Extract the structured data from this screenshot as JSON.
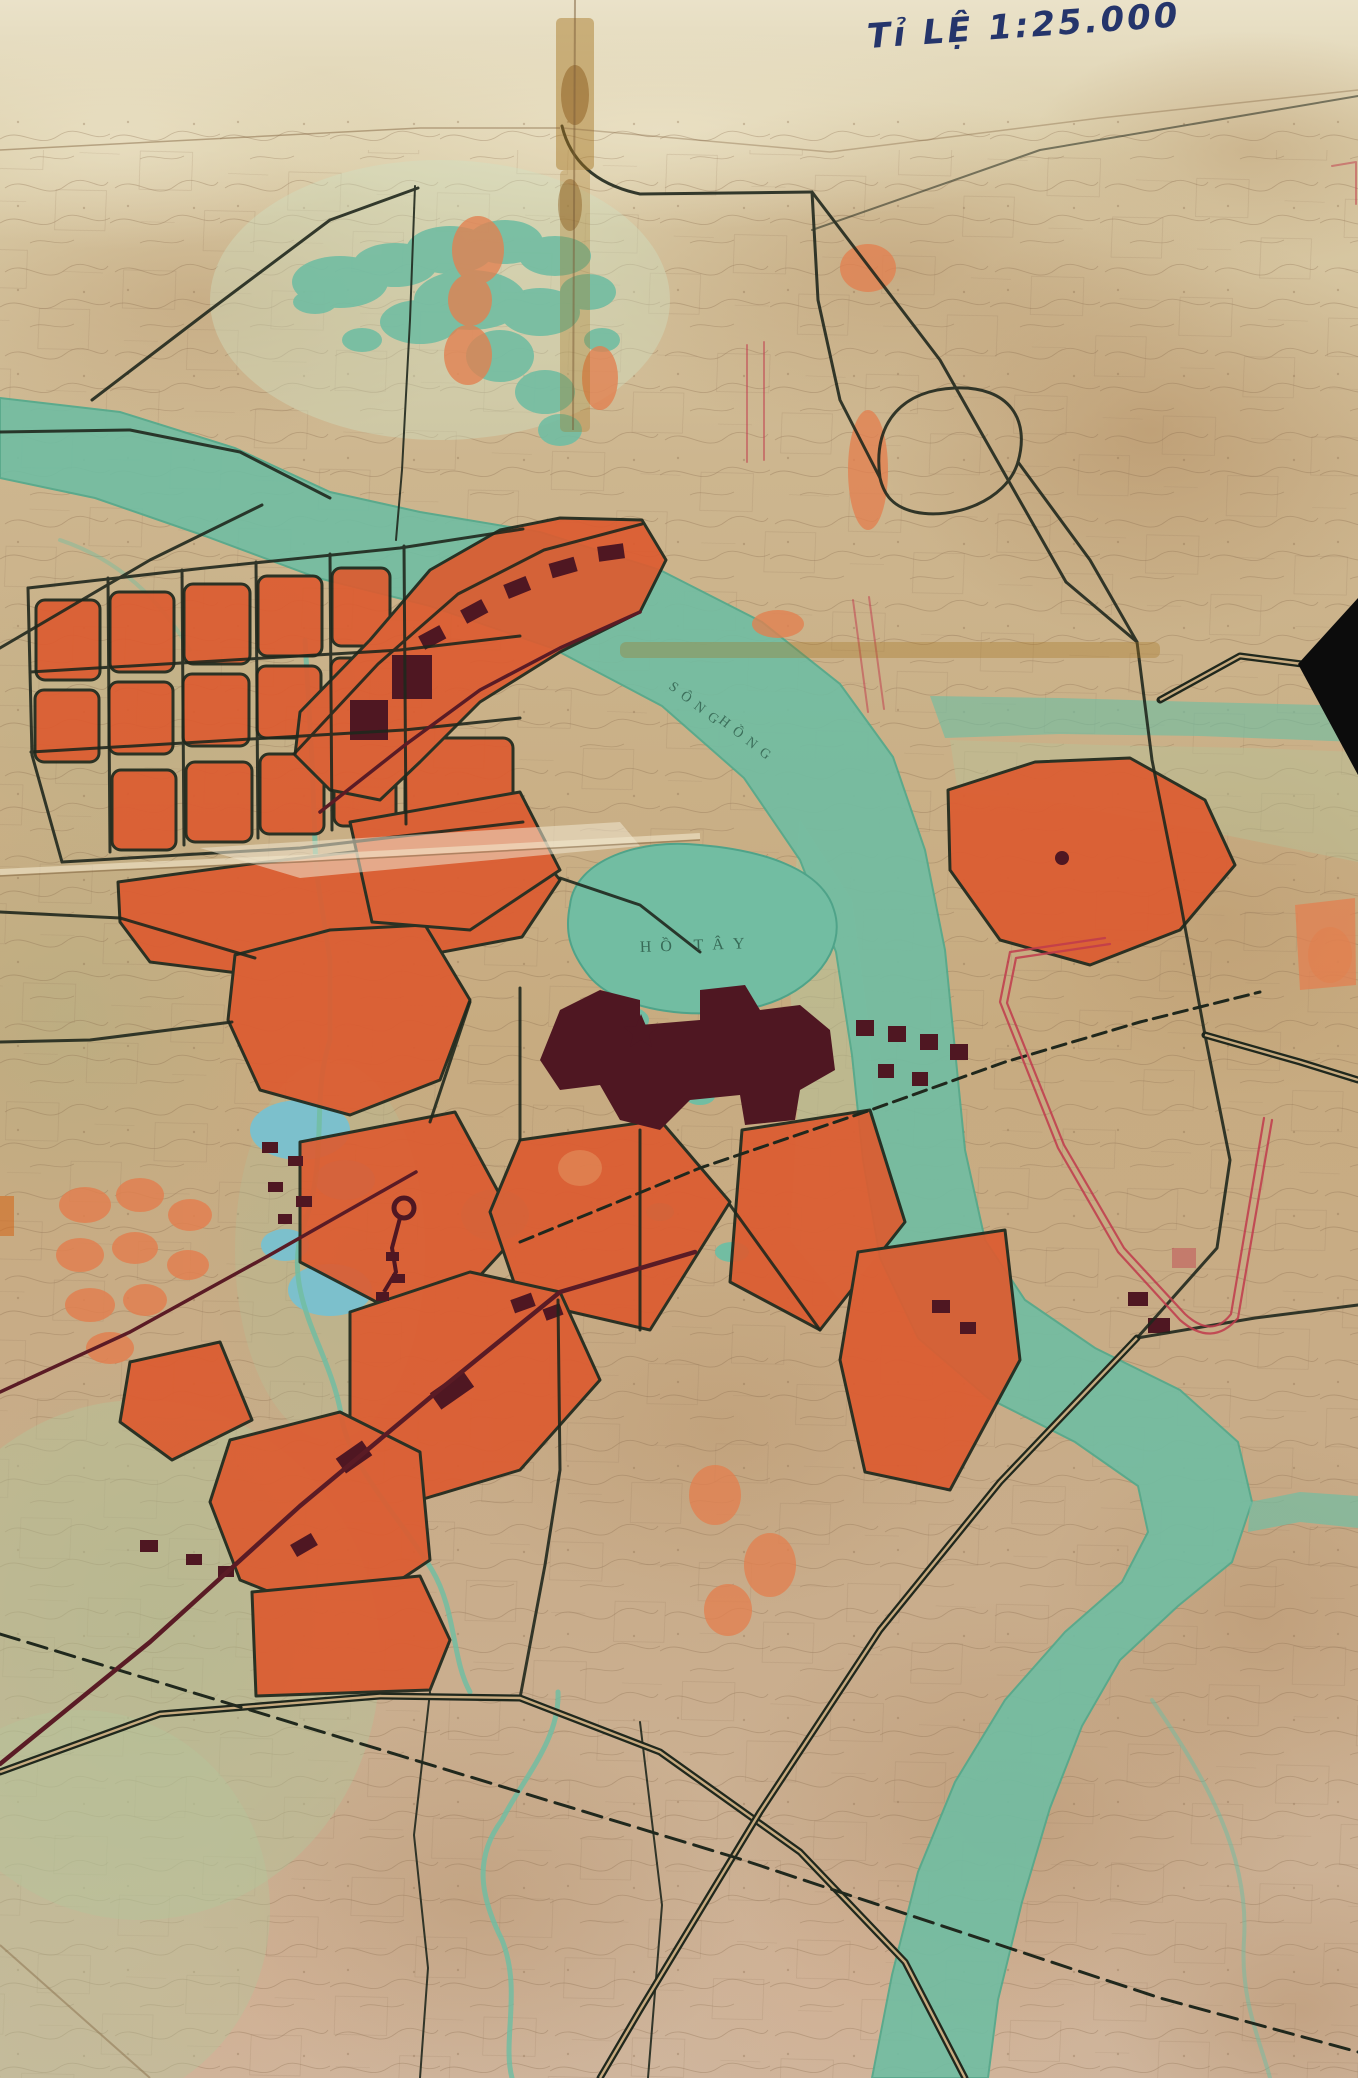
{
  "map": {
    "type": "scanned-urban-planning-map",
    "title": "Tỉ LỆ 1:25.000",
    "labels": {
      "lake": "HỒ TÂY",
      "river_word1": "SÔNG",
      "river_word2": "HỒNG"
    },
    "colors": {
      "paperTop": "#e9e1c8",
      "paper": "#cdb692",
      "paperWarm": "#b98c5e",
      "paperCream": "#efe7cd",
      "paperGreen": "#a9b183",
      "paperPink": "#d6ab8b",
      "water": "#72bda2",
      "waterDeep": "#55a88c",
      "waterBlue": "#7cc0cc",
      "wash": "#b3c59b",
      "zone": "#dc5c31",
      "zoneLight": "#e28050",
      "core": "#4f1722",
      "road": "#20281d",
      "roadMaroon": "#5a1b25",
      "planned": "#c03a4c",
      "ink": "#25356b",
      "tape": "#a5731f",
      "crease": "#7a5c38",
      "wedge": "#0c0c0c"
    }
  }
}
